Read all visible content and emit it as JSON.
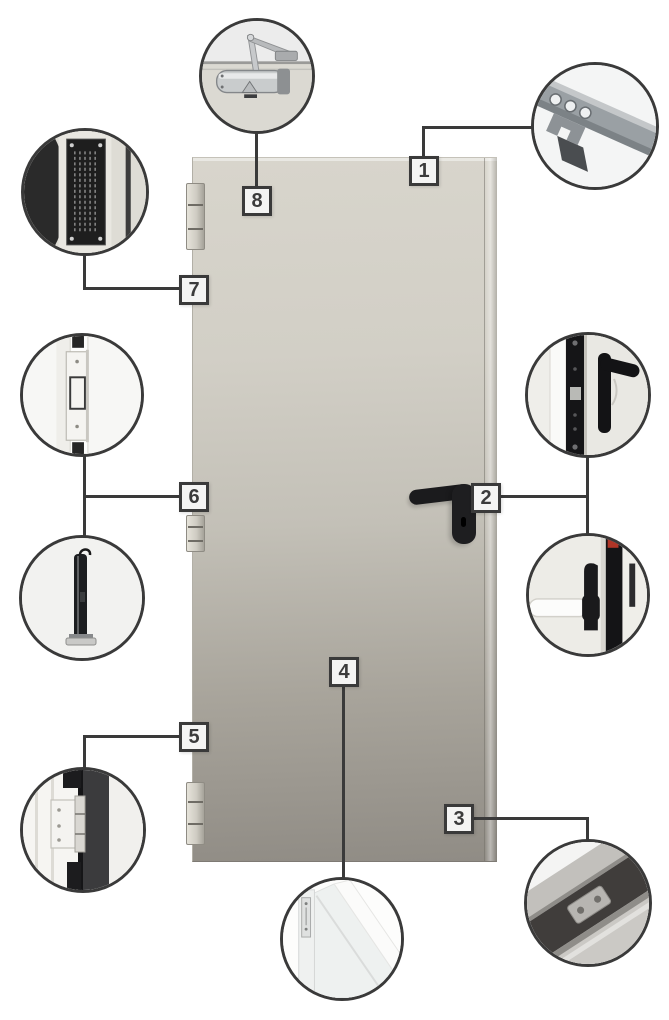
{
  "diagram": {
    "type": "fire-door-components-callout-diagram",
    "colors": {
      "background": "#ffffff",
      "outline": "#3a3a3a",
      "box_fill": "#f4f4f3",
      "number": "#3b3b3b",
      "door_top": "#d8d5cc",
      "door_bottom": "#908c85",
      "handle": "#1e1e20"
    },
    "callouts": [
      {
        "number": "1",
        "component": "frame-anchor-profile"
      },
      {
        "number": "2",
        "component": "lock-edge-handle-and-panic-bar"
      },
      {
        "number": "3",
        "component": "frame-corner-joint"
      },
      {
        "number": "4",
        "component": "door-leaf-cross-section"
      },
      {
        "number": "5",
        "component": "hinge-on-frame"
      },
      {
        "number": "6",
        "component": "hinge-and-closer-spring"
      },
      {
        "number": "7",
        "component": "certification-plate"
      },
      {
        "number": "8",
        "component": "overhead-door-closer"
      }
    ]
  }
}
